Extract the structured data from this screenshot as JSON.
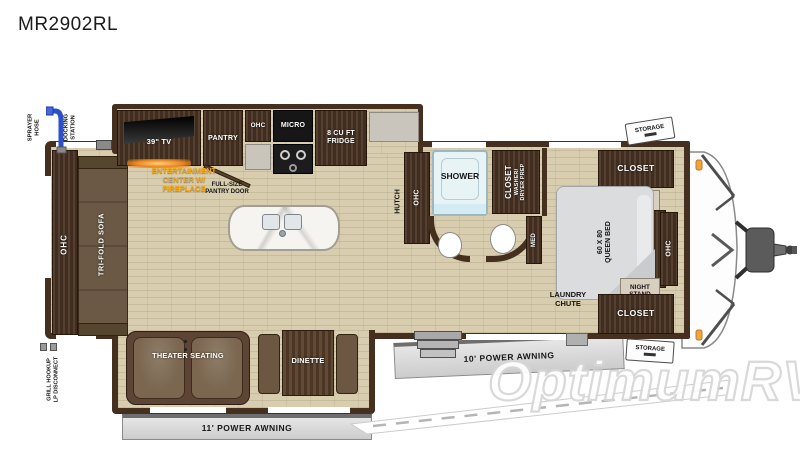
{
  "title": "MR2902RL",
  "colors": {
    "wall": "#45301f",
    "floor": "#d8cdaf",
    "wood": "#4a3424",
    "label_yellow": "#f0a818",
    "awning_gray": "#d9d9d9",
    "hose_blue": "#2b50c8",
    "marker_orange": "#f2a33c"
  },
  "exterior": {
    "sprayer_hose_line1": "SPRAYER",
    "sprayer_hose_line2": "HOSE",
    "docking_line1": "DOCKING",
    "docking_line2": "STATION",
    "grill_line1": "GRILL HOOKUP",
    "grill_line2": "LP DISCONNECT",
    "awning_left": "11' POWER AWNING",
    "awning_right": "10' POWER AWNING",
    "storage_top": "STORAGE",
    "storage_bottom": "STORAGE"
  },
  "living": {
    "ohc_left": "OHC",
    "sofa": "TRI-FOLD SOFA",
    "tv": "39\" TV",
    "ent_line1": "ENTERTAINMENT",
    "ent_line2": "CENTER W/",
    "ent_line3": "FIREPLACE",
    "pantry": "PANTRY",
    "pantry_door_line1": "FULL-SIZE",
    "pantry_door_line2": "PANTRY DOOR",
    "ohc_kitchen": "OHC",
    "micro": "MICRO",
    "fridge_line1": "8 CU FT",
    "fridge_line2": "FRIDGE",
    "theater": "THEATER SEATING",
    "dinette": "DINETTE",
    "hutch": "HUTCH",
    "ohc_hutch": "OHC"
  },
  "bath": {
    "shower": "SHOWER",
    "closet_line1": "CLOSET",
    "closet_line2": "WASHER/",
    "closet_line3": "DRYER PREP",
    "med": "MED"
  },
  "bedroom": {
    "closet_top": "CLOSET",
    "closet_bottom": "CLOSET",
    "ns_top_line1": "NIGHT",
    "ns_top_line2": "STAND",
    "ns_bot_line1": "NIGHT",
    "ns_bot_line2": "STAND",
    "bed_line1": "60 X 80",
    "bed_line2": "QUEEN BED",
    "ohc": "OHC",
    "laundry_line1": "LAUNDRY",
    "laundry_line2": "CHUTE"
  },
  "watermark": "OptimumRV"
}
